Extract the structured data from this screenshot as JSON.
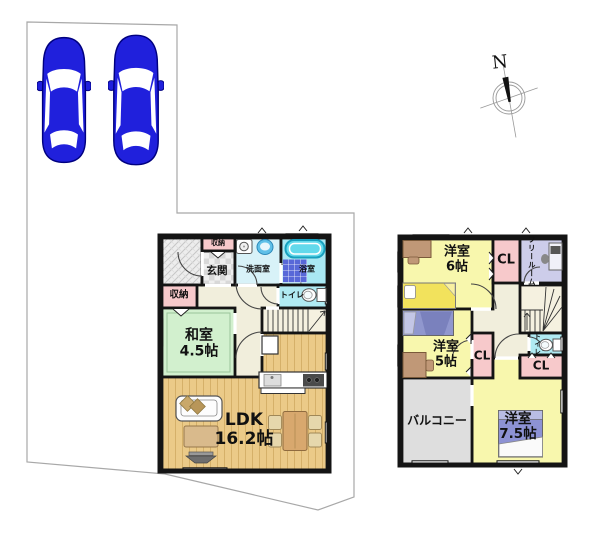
{
  "compass": {
    "north_label": "N"
  },
  "parking": {
    "spaces": 2
  },
  "floor1": {
    "entrance_storage": "収納",
    "entrance": "玄関",
    "washroom": "洗面室",
    "bathroom": "浴室",
    "storage": "収納",
    "toilet": "トイレ",
    "japanese_room": {
      "name": "和室",
      "size": "4.5帖"
    },
    "ldk": {
      "name": "LDK",
      "size": "16.2帖"
    }
  },
  "floor2": {
    "bedroom_6": {
      "name": "洋室",
      "size": "6帖"
    },
    "closet_1": "CL",
    "free_room": "フリールーム",
    "bedroom_5": {
      "name": "洋室",
      "size": "5帖"
    },
    "closet_2": "CL",
    "toilet": "トイレ",
    "closet_3": "CL",
    "balcony": "バルコニー",
    "bedroom_75": {
      "name": "洋室",
      "size": "7.5帖"
    }
  },
  "colors": {
    "car_blue": "#2020DC",
    "wall": "#141414",
    "boundary_line": "#A8A8A8",
    "wood_floor": "#EBCA88",
    "tatami_green": "#D2F0CE",
    "closet_pink": "#F7C9CB",
    "bedroom_yellow": "#F8F7AD",
    "free_room_lavender": "#CDCDEA",
    "balcony_gray": "#DEDEDE",
    "hall_beige": "#F1EEDC",
    "washroom_cyan": "#D8F2F8",
    "bath_cyan": "#A9E8F3",
    "toilet_cyan": "#B0EAF2",
    "stair_cream": "#F5F1E0",
    "bed_yellow": "#F2E25C",
    "bed_blue": "#9097CE",
    "bed_purple": "#8D92D4",
    "desk_brown": "#C09877"
  }
}
